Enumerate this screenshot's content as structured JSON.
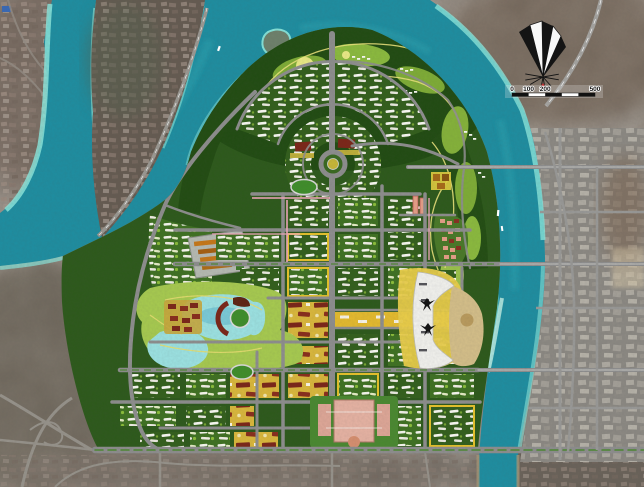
{
  "map": {
    "kind": "urban-master-plan-aerial",
    "scale_bar": {
      "tick_labels": [
        "0",
        "100",
        "200",
        "500"
      ]
    },
    "icons": {
      "compass": "compass-rose-north-arrow",
      "scale": "alternating-bar-scale"
    },
    "colors": {
      "river": "#1e8fa2",
      "river_shallow": "#8ce9de",
      "forest": "#2d5a1b",
      "hill_dark": "#214c12",
      "fairway": "#7fae36",
      "park": "#a8cc50",
      "lake": "#9de4e4",
      "road": "#8f8f8f",
      "axis_gold": "#e6bc2e",
      "building_white": "#f4f4f0",
      "building_maroon": "#7c2618",
      "commercial_yellow": "#e8c42a",
      "civic_pink": "#e8b4a4",
      "beach_sand": "#d6c08a",
      "existing_city": "#8d8a84",
      "satellite_base": "#7d736b",
      "compass_ink": "#141414"
    },
    "features": [
      "west-river-arm",
      "main-river",
      "river-island",
      "island-expressway",
      "golf-course-hill",
      "residential-fan",
      "roundabout",
      "twin-towers",
      "central-lakes",
      "lake-park",
      "arena-stadium",
      "running-tracks",
      "golden-axis",
      "riverfront-crescent-complex",
      "bird-sculptures",
      "beach",
      "civic-campus",
      "maroon-tower-district",
      "school-campus",
      "terraced-resort",
      "west-forest",
      "river-bridges",
      "existing-city-east",
      "highway-interchange",
      "boats",
      "compass-rose",
      "scale-bar"
    ]
  }
}
